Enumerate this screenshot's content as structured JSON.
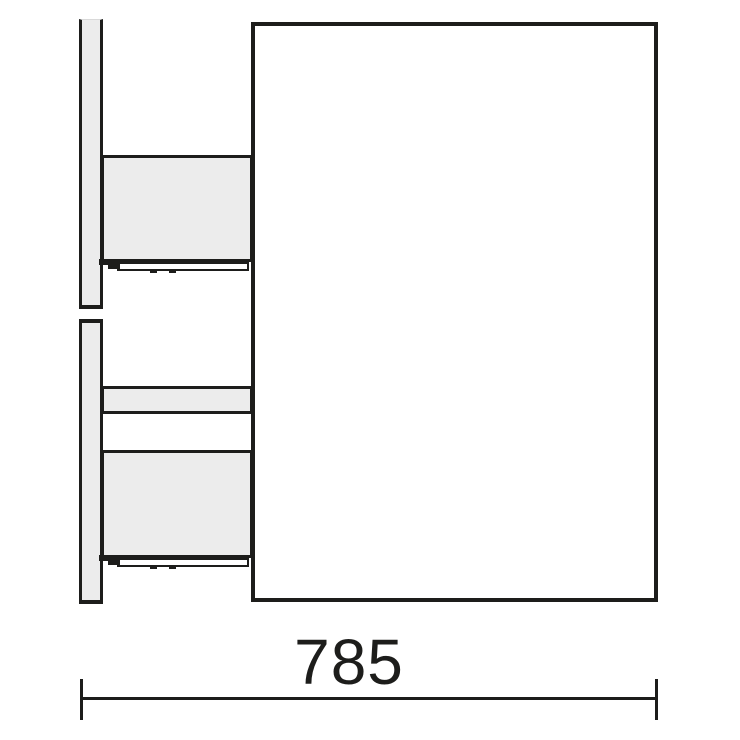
{
  "diagram": {
    "dimension": {
      "label": "785"
    },
    "colors": {
      "line": "#1d1d1b",
      "panel-fill": "#ececec",
      "background": "#ffffff"
    }
  }
}
